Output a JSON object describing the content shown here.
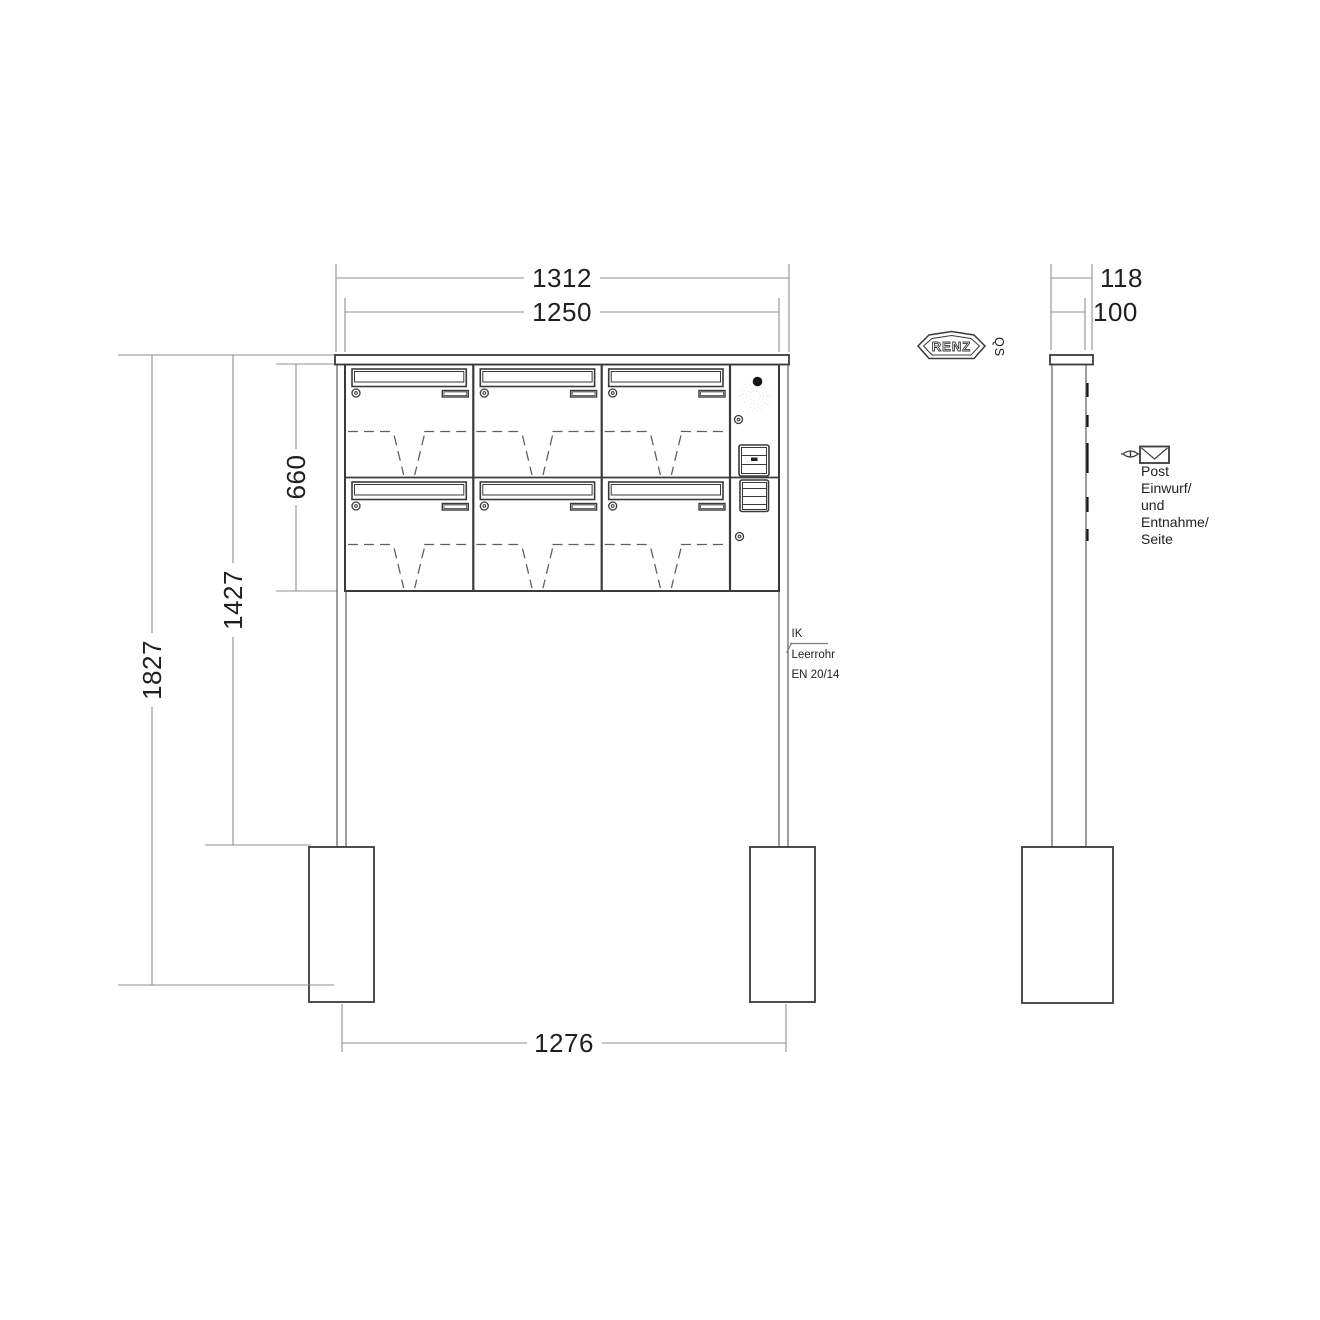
{
  "title": "RENZ free-standing letterbox unit - dimension drawing",
  "brand": {
    "logo": "RENZ",
    "qs": "QS"
  },
  "front_view": {
    "grid": {
      "columns": 3,
      "rows": 2,
      "boxes": 6
    },
    "dims": {
      "overall_width": "1312",
      "body_width": "1250",
      "body_height": "660",
      "clearance_height": "1427",
      "total_height": "1827",
      "anchor_spacing": "1276"
    }
  },
  "side_view": {
    "dims": {
      "roof_depth": "118",
      "post_depth": "100"
    }
  },
  "notes": {
    "conduit": {
      "line1": "IK",
      "line2": "Leerrohr",
      "line3": "EN 20/14"
    },
    "post_access": {
      "lines": [
        "Post",
        "Einwurf/",
        "und",
        "Entnahme/",
        "Seite"
      ]
    }
  },
  "colors": {
    "background": "#ffffff",
    "outline": "#3a3a3a",
    "dimension_line": "#8f8f8f",
    "text": "#1f1f1f"
  }
}
